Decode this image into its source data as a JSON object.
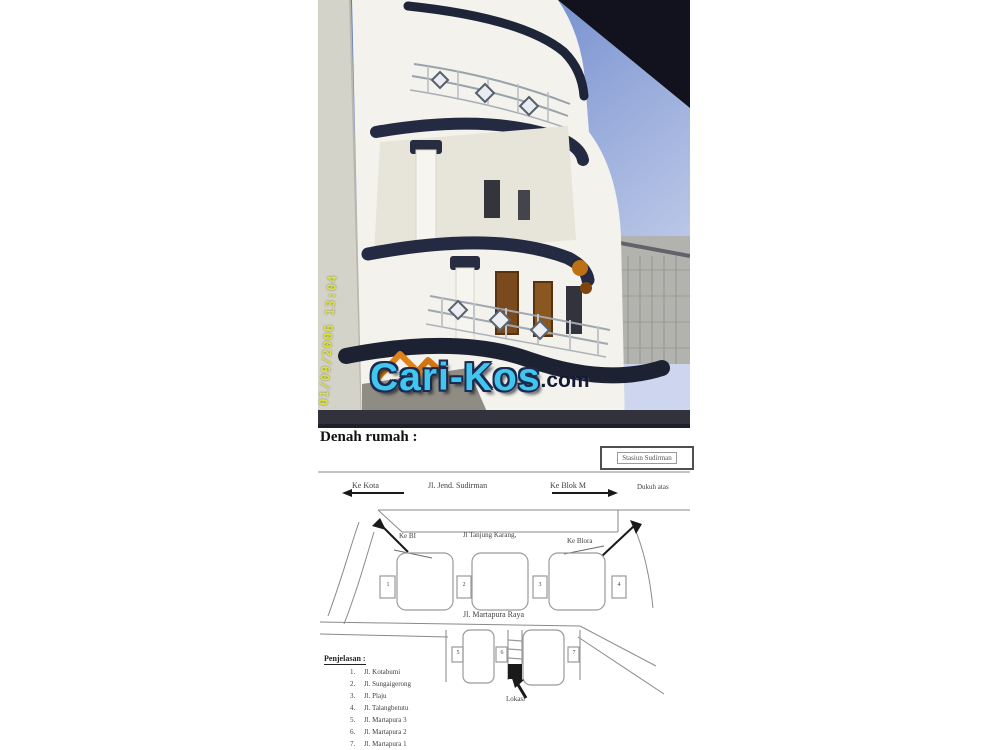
{
  "photo": {
    "timestamp": "01/09/2006 13:04",
    "logo": {
      "brand": "Cari-Kos",
      "suffix": ".com"
    },
    "colors": {
      "logo_brand": "#41c7ef",
      "logo_suffix": "#131b34",
      "logo_roof": "#e08018",
      "sky": "#5072c2",
      "building_trim": "#1f2538",
      "building_wall": "#f3f2ec",
      "timestamp_yellow": "#dde23e"
    }
  },
  "plan": {
    "heading": "Denah rumah :",
    "station_label": "Stasiun Sudirman",
    "roads": {
      "ke_kota": "Ke Kota",
      "jl_jend_sudirman": "Jl. Jend. Sudirman",
      "ke_blok_m": "Ke Blok M",
      "dukuh_atas": "Dukuh atas",
      "ke_bi": "Ke BI",
      "jl_tanjung_karang": "Jl Tanjung Karang,",
      "ke_blora": "Ke Blora",
      "jl_martapura_raya": "Jl. Martapura Raya"
    },
    "markers": {
      "n1": "1",
      "n2": "2",
      "n3": "3",
      "n4": "4",
      "n5": "5",
      "n6": "6",
      "n7": "7"
    },
    "lokasi": "Lokasi",
    "legend": {
      "title": "Penjelasan :",
      "items": [
        {
          "num": "1.",
          "name": "Jl. Kotabumi"
        },
        {
          "num": "2.",
          "name": "Jl. Sungaigerong"
        },
        {
          "num": "3.",
          "name": "Jl. Plaju"
        },
        {
          "num": "4.",
          "name": "Jl. Talangbetutu"
        },
        {
          "num": "5.",
          "name": "Jl. Martapura 3"
        },
        {
          "num": "6.",
          "name": "Jl. Martapura 2"
        },
        {
          "num": "7.",
          "name": "Jl. Martapura 1"
        }
      ]
    }
  }
}
